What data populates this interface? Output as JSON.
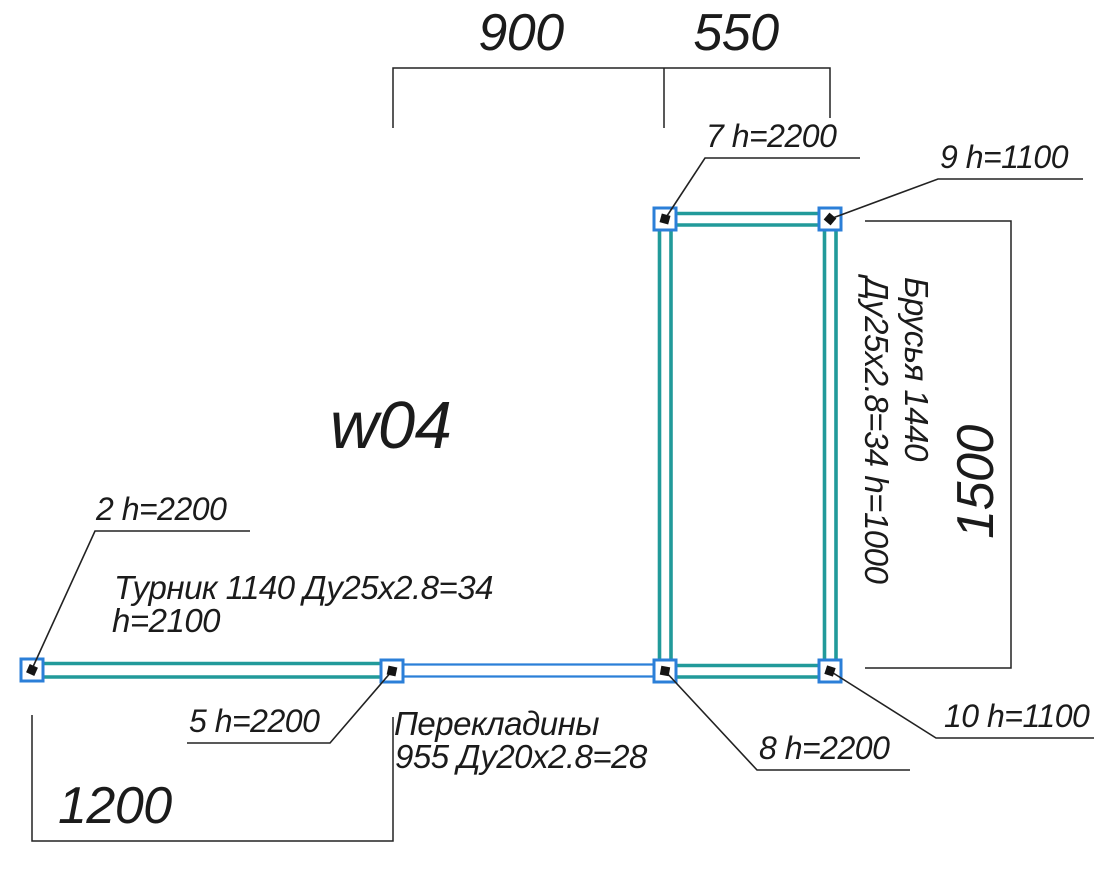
{
  "drawing_title": "w04",
  "dimensions": {
    "span_900": "900",
    "span_550": "550",
    "span_1200": "1200",
    "span_1500": "1500"
  },
  "post_labels": {
    "p2": "2 h=2200",
    "p5": "5 h=2200",
    "p7": "7 h=2200",
    "p8": "8 h=2200",
    "p9": "9 h=1100",
    "p10": "10 h=1100"
  },
  "annotations": {
    "turnik": {
      "line1": "Турник 1140 Ду25x2.8=34",
      "line2": "h=2100"
    },
    "perekladiny": {
      "line1": "Перекладины",
      "line2": "955 Ду20x2.8=28"
    },
    "brusya": {
      "line1": "Брусья 1440",
      "line2": "Ду25x2.8=34 h=1000"
    }
  },
  "colors": {
    "pipe_primary_teal": "#219a9a",
    "pipe_secondary_blue": "#2b7fd8",
    "dimension_black": "#222222",
    "text_black": "#1b1b1b"
  }
}
